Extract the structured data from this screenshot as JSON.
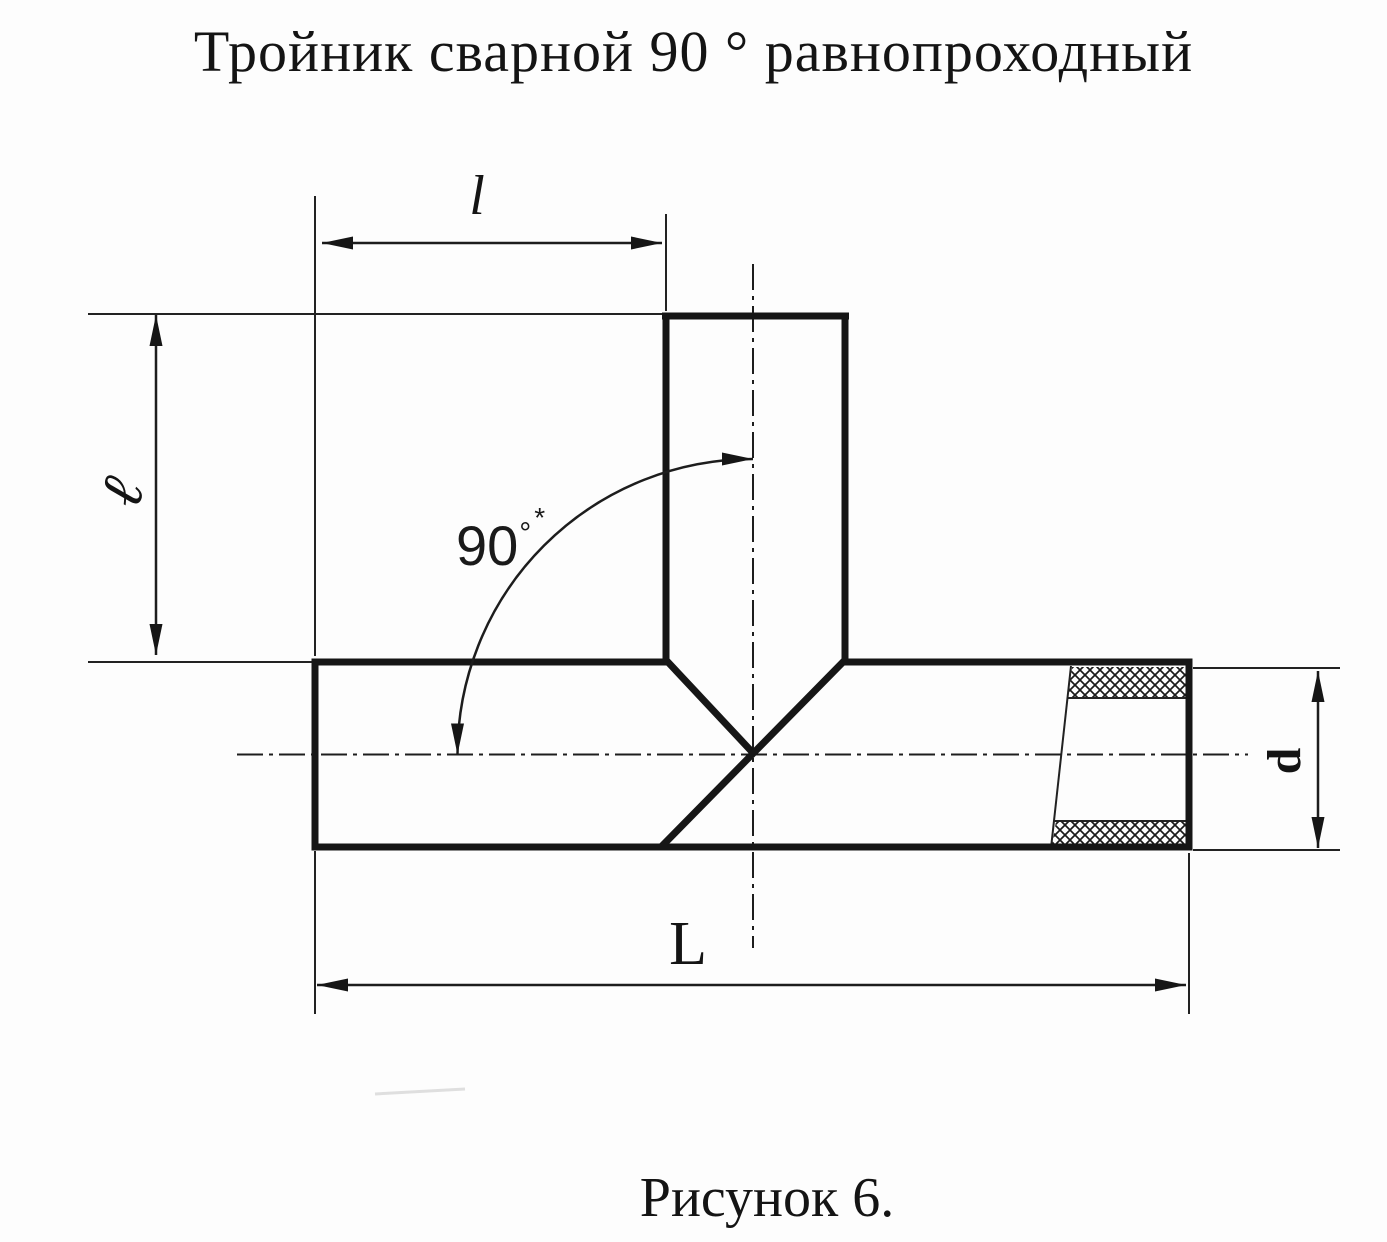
{
  "page": {
    "title": "Тройник сварной 90 ° равнопроходный",
    "caption": "Рисунок 6."
  },
  "dimensions": {
    "branch_length": {
      "label": "l"
    },
    "branch_height": {
      "label": "ℓ"
    },
    "overall_length": {
      "label": "L"
    },
    "pipe_diameter": {
      "label": "d"
    },
    "branch_angle": {
      "value": "90",
      "degree_sign": "°",
      "footnote_mark": "*"
    }
  },
  "colors": {
    "line": "#161616",
    "background": "#fdfdfd"
  }
}
